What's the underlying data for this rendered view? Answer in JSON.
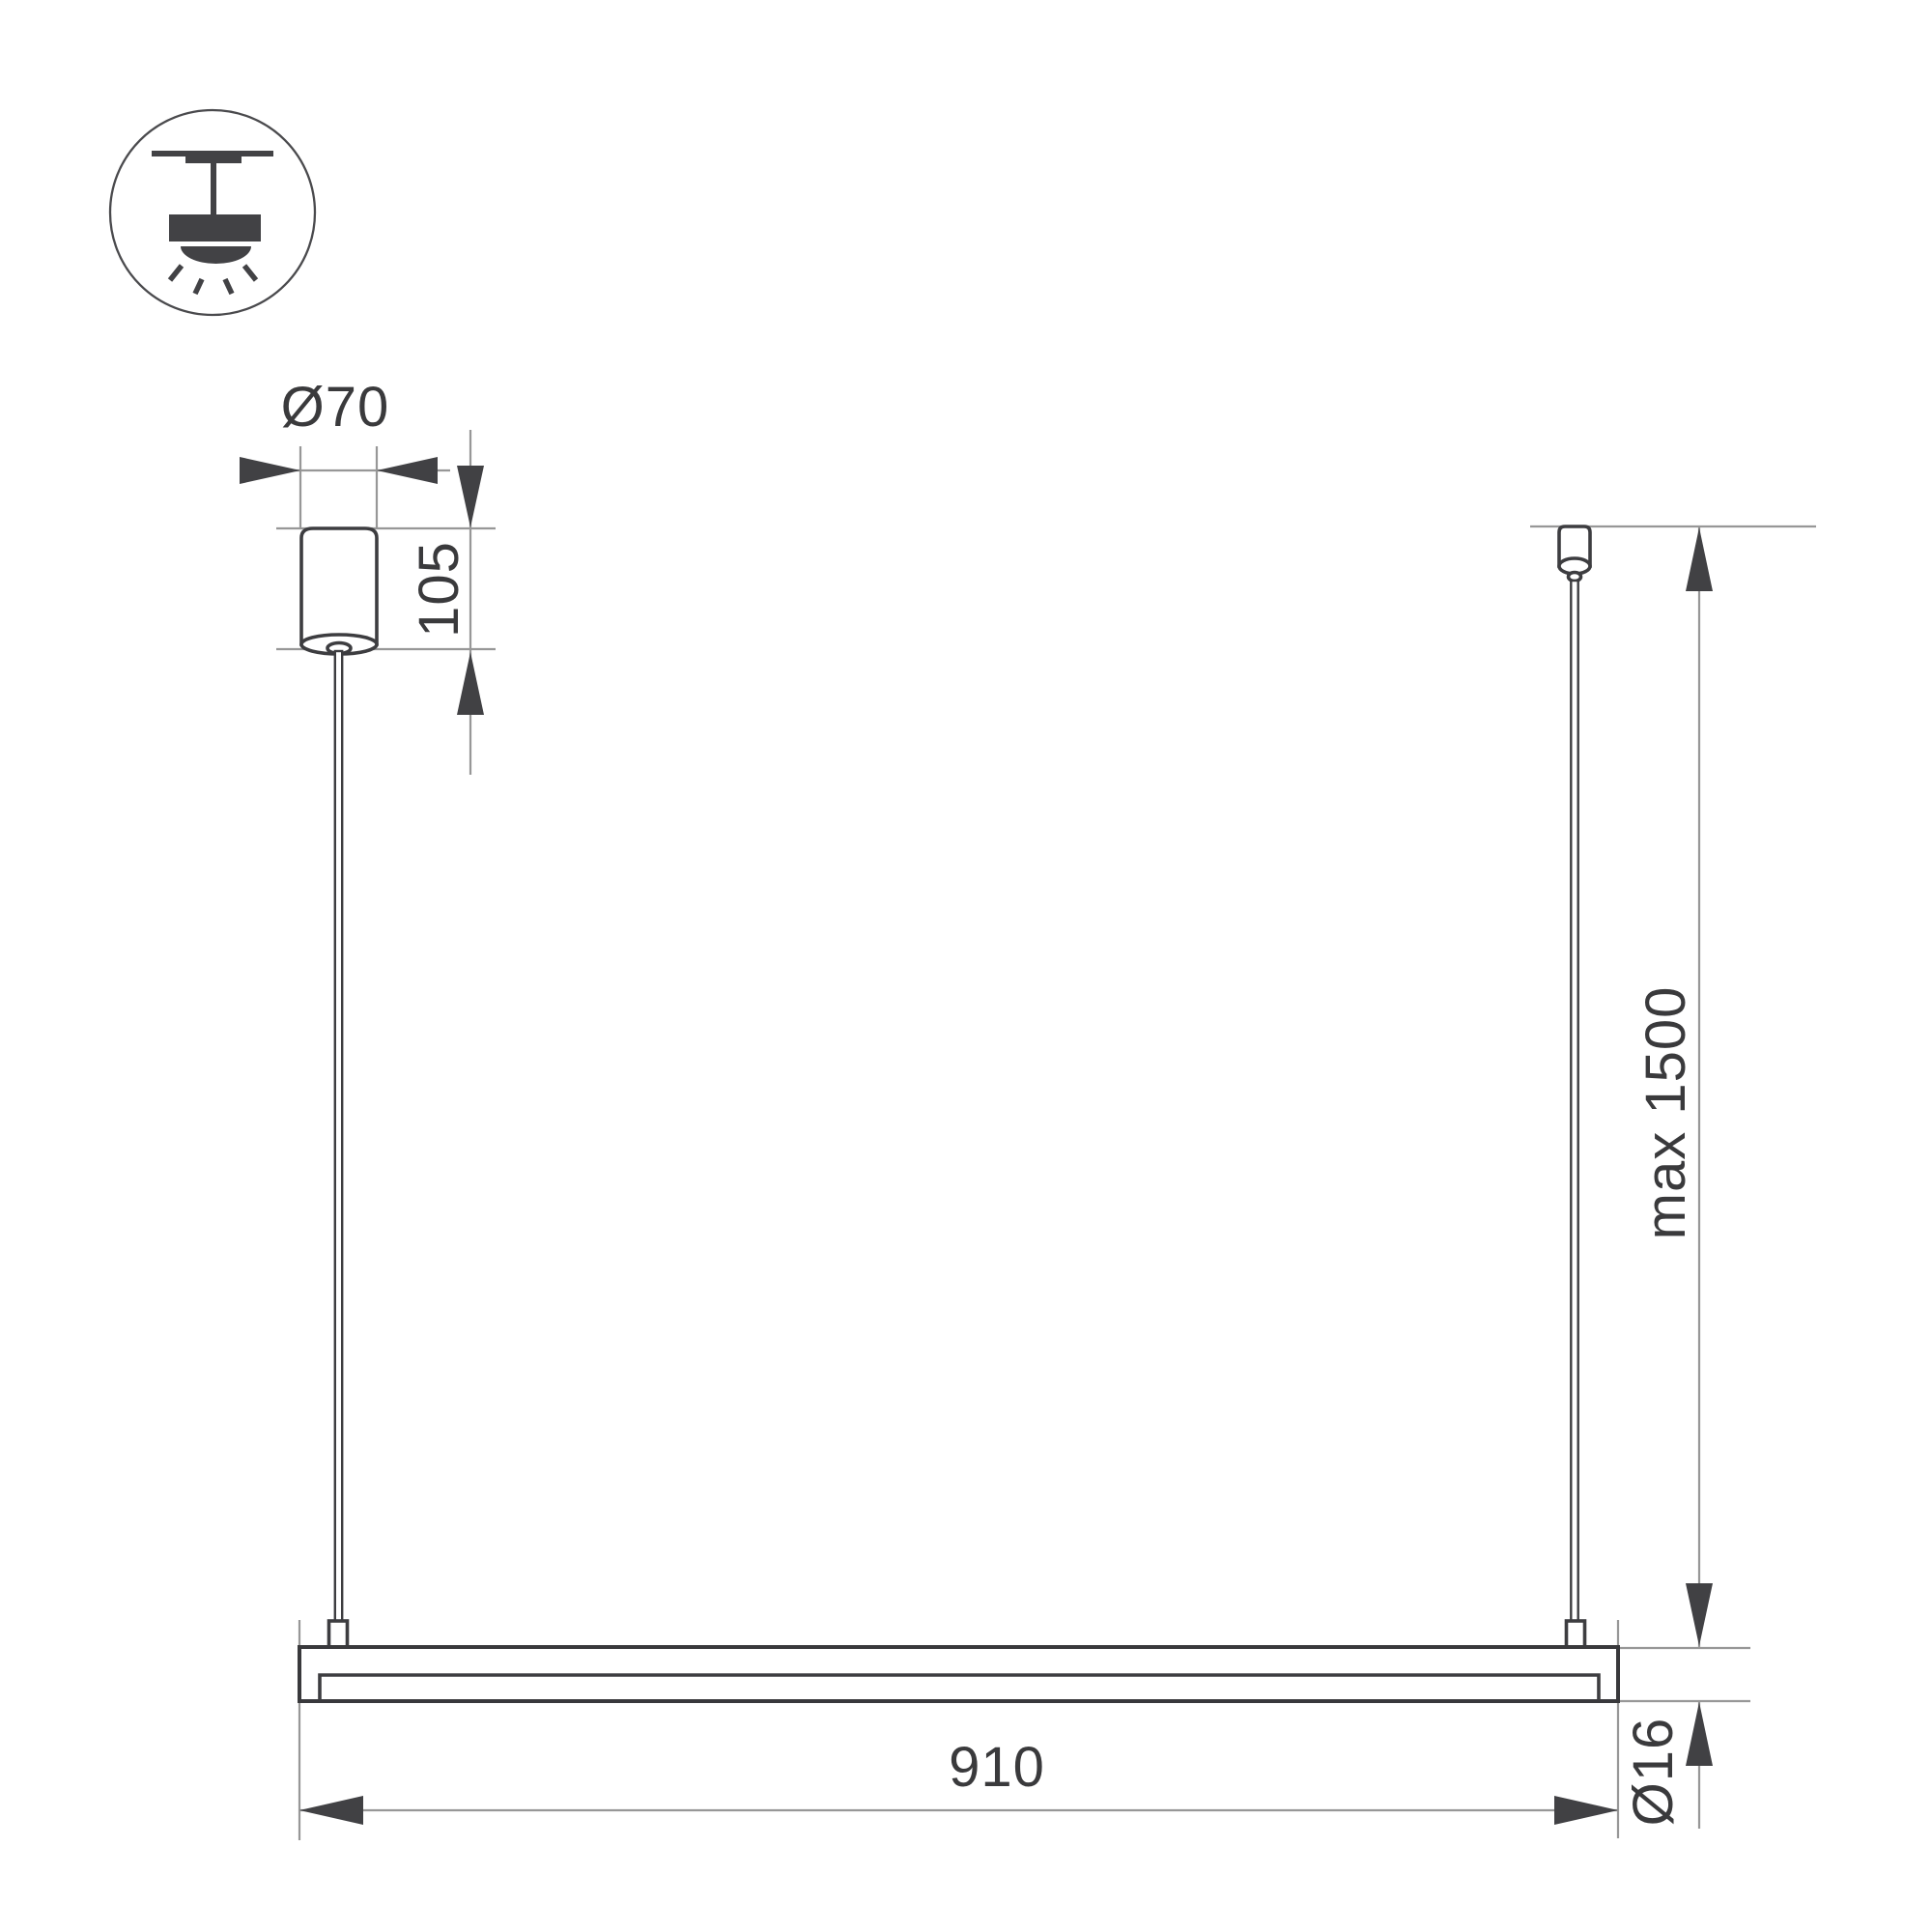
{
  "title": "Linear pendant luminaire installation dimension drawing",
  "icon": {
    "name": "pendant-ceiling-light",
    "description": "ceiling-mounted pendant luminaire pictogram with downward light rays"
  },
  "colors": {
    "outline_dark": "#3d3d40",
    "dimension_line_gray": "#979797",
    "arrow_fill": "#414144",
    "text": "#3a3a3c",
    "background": "#ffffff"
  },
  "dimensions": {
    "canopy_diameter": "Ø70",
    "canopy_height": "105",
    "suspension_length": "max 1500",
    "fixture_length": "910",
    "tube_diameter": "Ø16"
  }
}
